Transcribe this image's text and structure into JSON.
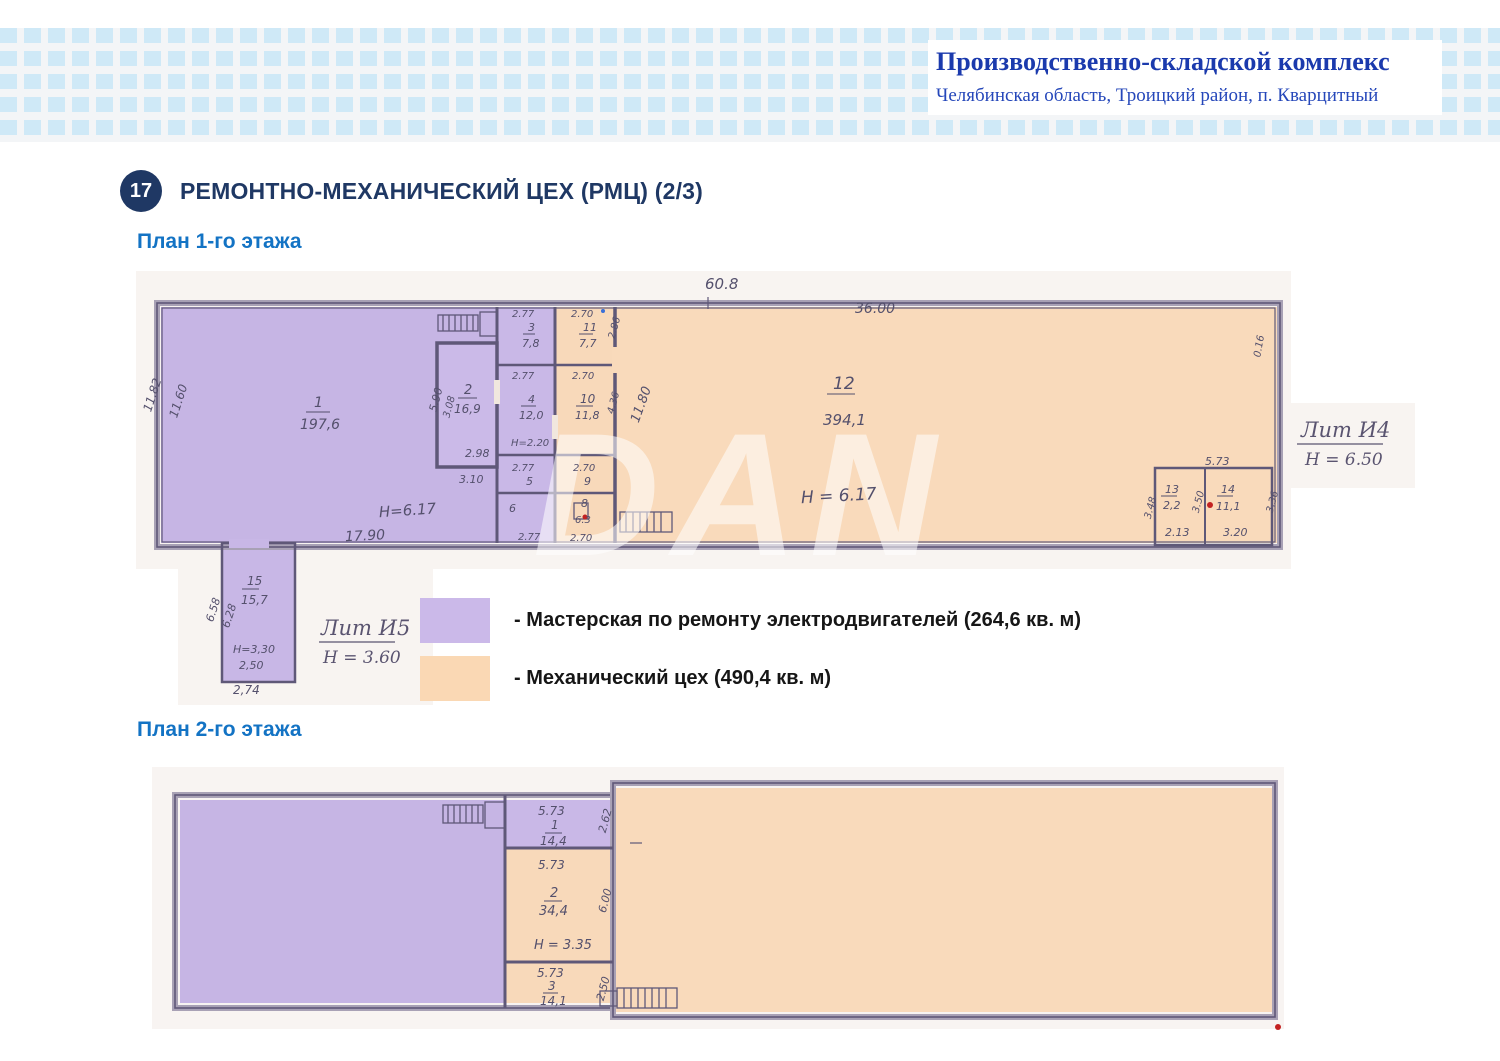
{
  "header": {
    "title": "Производственно-складской комплекс",
    "subtitle": "Челябинская область, Троицкий район, п. Кварцитный"
  },
  "section": {
    "badge": "17",
    "title": "РЕМОНТНО-МЕХАНИЧЕСКИЙ ЦЕХ (РМЦ) (2/3)"
  },
  "watermark": "DAN",
  "legend": {
    "items": [
      {
        "color": "#cbb9e9",
        "label": "- Мастерская по ремонту электродвигателей (264,6 кв. м)"
      },
      {
        "color": "#fad8b4",
        "label": "- Механический цех (490,4 кв. м)"
      }
    ]
  },
  "plan1": {
    "heading": "План 1-го этажа",
    "dims": {
      "top_total": "60.8",
      "top_right": "36.00",
      "left_outer": "11.82",
      "left_inner": "11.60",
      "bottom": "17.90",
      "right_edge": "0.16"
    },
    "room1": {
      "num": "1",
      "area": "197,6",
      "height": "H=6.17"
    },
    "room2": {
      "num": "2",
      "area": "16,9",
      "dim_left_a": "5.90",
      "dim_left_b": "3.08",
      "dim_bottom_a": "2.98",
      "dim_bottom_b": "3.10"
    },
    "room3": {
      "num": "3",
      "area": "7,8",
      "dim_top": "2.77"
    },
    "room4": {
      "num": "4",
      "area": "12,0",
      "dim_top": "2.77",
      "height": "H=2.20"
    },
    "room5": {
      "num": "5",
      "dim_top": "2.77"
    },
    "room6": {
      "num": "6",
      "dim_bottom": "2.77"
    },
    "room8": {
      "num": "8",
      "area": "6.3",
      "dim_bottom": "2.70"
    },
    "room9": {
      "num": "9",
      "dim_top": "2.70"
    },
    "room10": {
      "num": "10",
      "area": "11,8",
      "dim_top": "2.70",
      "dim_right": "4.36",
      "dim_diag": "11.80"
    },
    "room11": {
      "num": "11",
      "area": "7,7",
      "dim_top": "2.70",
      "dim_right": "2.86"
    },
    "room12": {
      "num": "12",
      "area": "394,1",
      "height": "H = 6.17"
    },
    "room13": {
      "num": "13",
      "area": "2,2",
      "dim_bottom": "2.13",
      "dim_left": "3.48",
      "dim_mid": "3.50"
    },
    "room14": {
      "num": "14",
      "area": "11,1",
      "dim_top": "5.73",
      "dim_bottom": "3.20",
      "dim_right": "3.36"
    },
    "room15": {
      "num": "15",
      "area": "15,7",
      "dim_left_a": "6.58",
      "dim_left_b": "6.28",
      "height": "H=3,30",
      "dim_inner": "2,50",
      "dim_bottom": "2,74"
    },
    "note_right": {
      "lit": "Лит И4",
      "height": "H = 6.50"
    },
    "note_annex": {
      "lit": "Лит И5",
      "height": "H = 3.60"
    }
  },
  "plan2": {
    "heading": "План 2-го этажа",
    "room1": {
      "num": "1",
      "area": "14,4",
      "dim_top": "5.73",
      "dim_right": "2.62"
    },
    "room2": {
      "num": "2",
      "area": "34,4",
      "dim_top": "5.73",
      "height": "H = 3.35",
      "dim_right": "6.00"
    },
    "room3": {
      "num": "3",
      "area": "14,1",
      "dim_top": "5.73",
      "dim_right": "2.50"
    }
  }
}
